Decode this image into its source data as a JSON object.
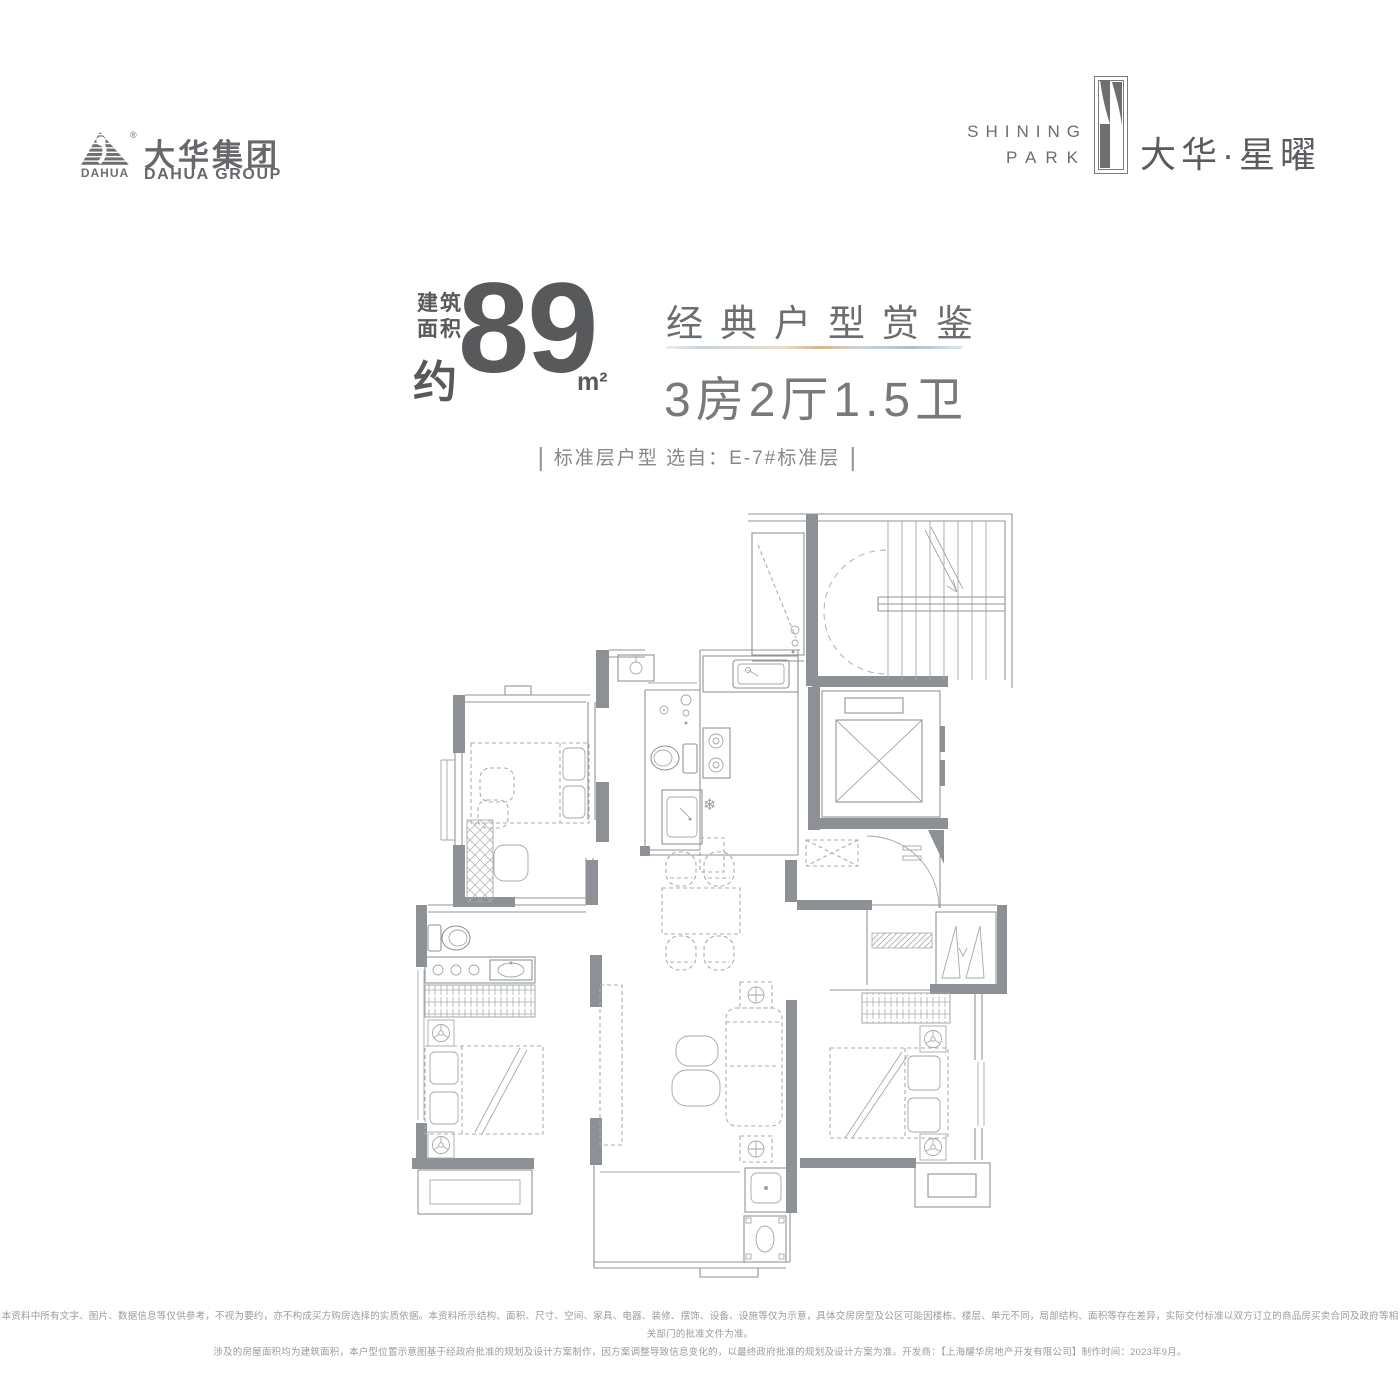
{
  "brand": {
    "logo_text": "DAHUA",
    "registered": "®",
    "name_cn": "大华集团",
    "name_en": "DAHUA GROUP"
  },
  "project": {
    "name_en_line1": "SHINING",
    "name_en_line2": "PARK",
    "name_cn": "大华·星曜"
  },
  "headline": {
    "area_label_1": "建筑",
    "area_label_2": "面积",
    "area_approx": "约",
    "area_value": "89",
    "area_unit": "m²",
    "series_title": "经典户型赏鉴",
    "layout_spec": "3房2厅1.5卫"
  },
  "selection_note": {
    "text": "标准层户型  选自：E-7#标准层"
  },
  "footer": {
    "line1": "本资料中所有文字、图片、数据信息等仅供参考，不视为要约，亦不构成买方购房选择的实质依据。本资料所示结构、面积、尺寸、空间、家具、电器、装修、摆饰、设备、设施等仅为示意，具体交房房型及公区可能因楼栋、楼层、单元不同，局部结构、面积等存在差异，实际交付标准以双方订立的商品房买卖合同及政府等相关部门的批准文件为准。",
    "line2": "涉及的房屋面积均为建筑面积，本户型位置示意图基于经政府批准的规划及设计方案制作，因方案调整导致信息变化的，以最终政府批准的规划及设计方案为准。开发商：【上海耀华房地产开发有限公司】制作时间：2023年9月。"
  },
  "colors": {
    "text_primary": "#58595b",
    "text_secondary": "#6b6d70",
    "text_tertiary": "#85878a",
    "wall_gray": "#8d9195",
    "line_gray": "#8f9598",
    "accent_gradient": [
      "#eceeee",
      "#c9d3d8",
      "#e6dcc8",
      "#dbb48c",
      "#a9c0d2",
      "#dfe5e8"
    ]
  }
}
